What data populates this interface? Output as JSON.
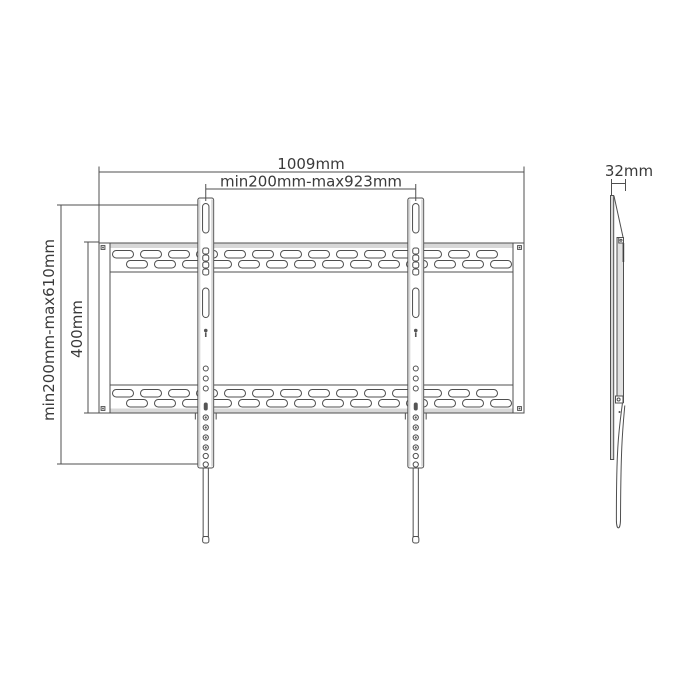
{
  "front_view": {
    "dim_total_width": "1009mm",
    "dim_horizontal_pattern": "min200mm-max923mm",
    "dim_vertical_pattern_range": "min200mm-max610mm",
    "dim_vertical_pattern": "400mm"
  },
  "side_view": {
    "dim_depth": "32mm"
  },
  "colors": {
    "line": "#4f4f4f",
    "text": "#3a3a3a",
    "shade": "#d8d8d8",
    "background": "#ffffff"
  }
}
